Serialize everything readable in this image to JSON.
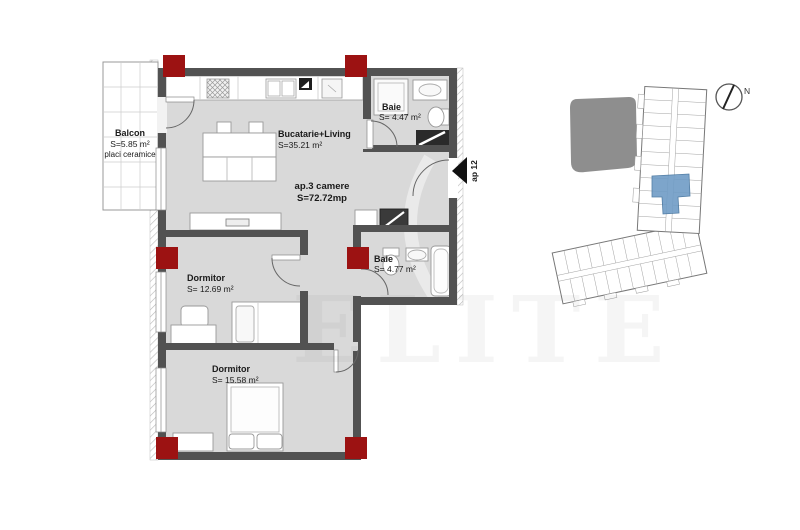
{
  "watermark": "ELITE",
  "colors": {
    "wall": "#525252",
    "floor": "#d9d9d9",
    "column": "#9c1212",
    "unit_label": "#c02a2a",
    "highlight_unit": "#6f9cc6"
  },
  "plan": {
    "unit": {
      "name": "ap.3 camere",
      "area": "S=72.72mp"
    },
    "entrance": {
      "label": "ap 12"
    },
    "rooms": {
      "balcon": {
        "name": "Balcon",
        "area": "S=5.85 m²",
        "finish": "placi ceramice"
      },
      "living": {
        "name": "Bucatarie+Living",
        "area": "S=35.21 m²"
      },
      "baie_top": {
        "name": "Baie",
        "area": "S= 4.47 m²"
      },
      "baie_mid": {
        "name": "Baie",
        "area": "S= 4.77 m²"
      },
      "dormitor_1": {
        "name": "Dormitor",
        "area": "S= 12.69 m²"
      },
      "dormitor_2": {
        "name": "Dormitor",
        "area": "S= 15.58 m²"
      }
    }
  },
  "site_plan": {
    "north_label": "N"
  }
}
